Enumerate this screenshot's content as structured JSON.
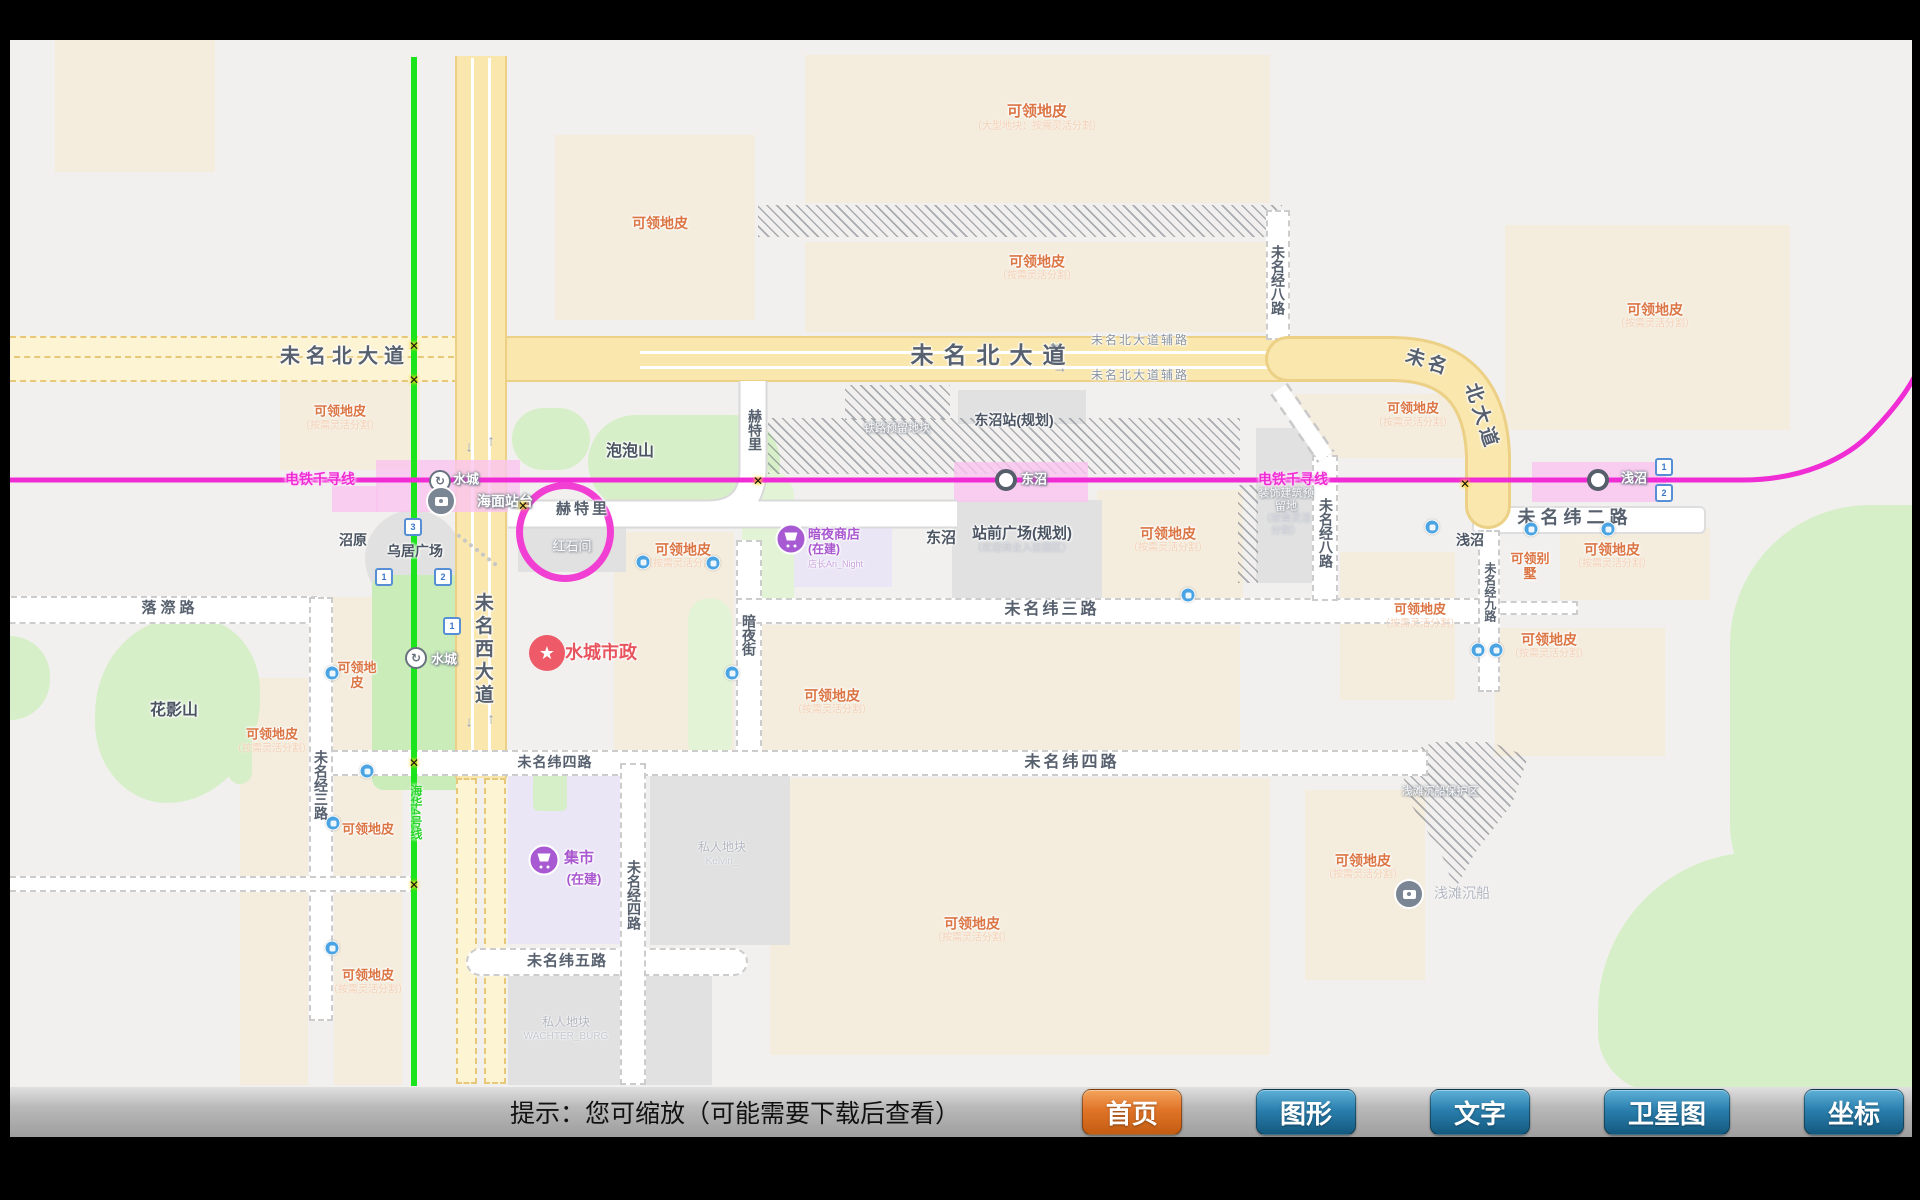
{
  "toolbar": {
    "hint": "提示：您可缩放（可能需要下载后查看）",
    "buttons": [
      {
        "label": "首页",
        "name": "home",
        "accent": true
      },
      {
        "label": "图形",
        "name": "graphics"
      },
      {
        "label": "文字",
        "name": "text"
      },
      {
        "label": "卫星图",
        "name": "satellite"
      },
      {
        "label": "坐标",
        "name": "coordinates"
      }
    ]
  },
  "map": {
    "colors": {
      "accent_orange": "#e07428",
      "button_blue": "#2a7fae",
      "metro_magenta": "#f02cd4",
      "metro_green": "#1ce41c",
      "claim_orange": "#db7544"
    },
    "labels": [
      {
        "t": "未名北大道",
        "x": 345,
        "y": 357,
        "s": 20,
        "ls": 6,
        "cls": "rd"
      },
      {
        "t": "未名北大道",
        "x": 993,
        "y": 355,
        "s": 23,
        "ls": 10,
        "cls": "rd"
      },
      {
        "t": "未名北大道辅路",
        "x": 1140,
        "y": 341,
        "s": 12,
        "ls": 2,
        "cls": "rd2"
      },
      {
        "t": "未名北大道辅路",
        "x": 1140,
        "y": 376,
        "s": 12,
        "ls": 2,
        "cls": "rd2"
      },
      {
        "t": "未名",
        "x": 1428,
        "y": 363,
        "s": 19,
        "ls": 4,
        "cls": "rd",
        "rot": 18
      },
      {
        "t": "北大道",
        "x": 1481,
        "y": 417,
        "s": 19,
        "ls": 4,
        "cls": "rd",
        "rot": 72
      },
      {
        "t": "未名西大道",
        "x": 482,
        "y": 650,
        "s": 19,
        "ls": 4,
        "v": 1,
        "cls": "rd"
      },
      {
        "t": "未名纬二路",
        "x": 1575,
        "y": 518,
        "s": 18,
        "ls": 5,
        "cls": "rd"
      },
      {
        "t": "未名纬三路",
        "x": 1052,
        "y": 610,
        "s": 16,
        "ls": 3,
        "cls": "rd"
      },
      {
        "t": "未名纬四路",
        "x": 555,
        "y": 762,
        "s": 14,
        "ls": 1,
        "cls": "rd"
      },
      {
        "t": "未名纬四路",
        "x": 1072,
        "y": 763,
        "s": 16,
        "ls": 3,
        "cls": "rd"
      },
      {
        "t": "未名纬五路",
        "x": 567,
        "y": 961,
        "s": 15,
        "ls": 1,
        "cls": "rd"
      },
      {
        "t": "落漈路",
        "x": 170,
        "y": 608,
        "s": 15,
        "ls": 4,
        "cls": "rd"
      },
      {
        "t": "未名经三路",
        "x": 321,
        "y": 785,
        "s": 14,
        "v": 1,
        "cls": "rd"
      },
      {
        "t": "未名经四路",
        "x": 634,
        "y": 895,
        "s": 14,
        "v": 1,
        "cls": "rd"
      },
      {
        "t": "未名经八路",
        "x": 1278,
        "y": 280,
        "s": 14,
        "v": 1,
        "cls": "rd"
      },
      {
        "t": "未名经八路",
        "x": 1326,
        "y": 533,
        "s": 14,
        "v": 1,
        "cls": "rd"
      },
      {
        "t": "未名经九路",
        "x": 1489,
        "y": 592,
        "s": 12,
        "v": 1,
        "cls": "rd"
      },
      {
        "t": "赫特里",
        "x": 583,
        "y": 509,
        "s": 15,
        "ls": 3,
        "cls": "rd"
      },
      {
        "t": "赫特里",
        "x": 755,
        "y": 430,
        "s": 14,
        "v": 1,
        "cls": "rd"
      },
      {
        "t": "暗夜街",
        "x": 749,
        "y": 635,
        "s": 14,
        "v": 1,
        "cls": "rd"
      },
      {
        "t": "泡泡山",
        "x": 630,
        "y": 452,
        "s": 16,
        "cls": "pl"
      },
      {
        "t": "花影山",
        "x": 174,
        "y": 711,
        "s": 16,
        "cls": "pl"
      },
      {
        "t": "沼原",
        "x": 353,
        "y": 540,
        "s": 14,
        "cls": "pl"
      },
      {
        "t": "乌居广场",
        "x": 415,
        "y": 551,
        "s": 14,
        "cls": "pl"
      },
      {
        "t": "东沼",
        "x": 941,
        "y": 538,
        "s": 15,
        "cls": "pl"
      },
      {
        "t": "浅沼",
        "x": 1470,
        "y": 540,
        "s": 14,
        "cls": "pl"
      },
      {
        "t": "东沼站(规划)",
        "x": 1014,
        "y": 420,
        "s": 14,
        "cls": "pl"
      },
      {
        "t": "站前广场(规划)",
        "x": 1022,
        "y": 540,
        "s": 15,
        "cls": "pl",
        "sub": "（欢迎商业入驻园区）"
      },
      {
        "t": "红石间",
        "x": 572,
        "y": 547,
        "s": 13,
        "cls": "wl"
      },
      {
        "t": "铁路预留地块",
        "x": 897,
        "y": 429,
        "s": 11,
        "cls": "wl"
      },
      {
        "t": "装饰建筑预留地",
        "x": 1286,
        "y": 512,
        "s": 11,
        "cls": "wl",
        "w": 56,
        "sub": "（按需灵活分割）"
      },
      {
        "t": "浅滩沉船保护区",
        "x": 1440,
        "y": 792,
        "s": 11,
        "cls": "wl"
      },
      {
        "t": "私人地块",
        "x": 722,
        "y": 854,
        "s": 12,
        "cls": "gl",
        "sub": "Kelvin_"
      },
      {
        "t": "私人地块",
        "x": 566,
        "y": 1029,
        "s": 12,
        "cls": "gl",
        "sub": "WACHTER_BURG"
      },
      {
        "t": "可领地皮",
        "x": 660,
        "y": 223,
        "s": 14,
        "cls": "cl"
      },
      {
        "t": "可领地皮",
        "x": 1037,
        "y": 118,
        "s": 15,
        "cls": "cl",
        "sub": "（大型地块：按需灵活分割）"
      },
      {
        "t": "可领地皮",
        "x": 1037,
        "y": 268,
        "s": 14,
        "cls": "cl",
        "sub": "（按需灵活分割）"
      },
      {
        "t": "可领地皮",
        "x": 1655,
        "y": 316,
        "s": 14,
        "cls": "cl",
        "sub": "（按需灵活分割）"
      },
      {
        "t": "可领地皮",
        "x": 340,
        "y": 418,
        "s": 13,
        "cls": "cl",
        "sub": "（按需灵活分割）"
      },
      {
        "t": "可领地皮",
        "x": 683,
        "y": 556,
        "s": 14,
        "cls": "cl",
        "sub": "（按需灵活分割）"
      },
      {
        "t": "可领地皮",
        "x": 1168,
        "y": 540,
        "s": 14,
        "cls": "cl",
        "sub": "（按需灵活分割）"
      },
      {
        "t": "可领地皮",
        "x": 832,
        "y": 702,
        "s": 14,
        "cls": "cl",
        "sub": "（按需灵活分割）"
      },
      {
        "t": "可领地皮",
        "x": 972,
        "y": 930,
        "s": 14,
        "cls": "cl",
        "sub": "（按需灵活分割）"
      },
      {
        "t": "可领地皮",
        "x": 272,
        "y": 741,
        "s": 13,
        "cls": "cl",
        "sub": "（按需灵活分割）"
      },
      {
        "t": "可领地皮",
        "x": 368,
        "y": 830,
        "s": 13,
        "cls": "cl"
      },
      {
        "t": "可领地皮",
        "x": 368,
        "y": 982,
        "s": 13,
        "cls": "cl",
        "sub": "（按需灵活分割）"
      },
      {
        "t": "可领地皮",
        "x": 357,
        "y": 676,
        "s": 13,
        "cls": "cl",
        "w": 46
      },
      {
        "t": "可领地皮",
        "x": 1612,
        "y": 556,
        "s": 14,
        "cls": "cl",
        "sub": "（按需灵活分割）"
      },
      {
        "t": "可领地皮",
        "x": 1420,
        "y": 616,
        "s": 13,
        "cls": "cl",
        "sub": "（按需灵活分割）"
      },
      {
        "t": "可领地皮",
        "x": 1549,
        "y": 646,
        "s": 14,
        "cls": "cl",
        "sub": "（按需灵活分割）"
      },
      {
        "t": "可领地皮",
        "x": 1363,
        "y": 867,
        "s": 14,
        "cls": "cl",
        "sub": "（按需灵活分割）"
      },
      {
        "t": "可领地皮",
        "x": 1413,
        "y": 415,
        "s": 13,
        "cls": "cl",
        "sub": "（按需灵活分割）"
      },
      {
        "t": "可领别墅",
        "x": 1530,
        "y": 567,
        "s": 13,
        "cls": "cl",
        "w": 42
      },
      {
        "t": "水城",
        "x": 466,
        "y": 480,
        "s": 13,
        "cls": "st"
      },
      {
        "t": "海面站台",
        "x": 505,
        "y": 501,
        "s": 14,
        "cls": "st"
      },
      {
        "t": "水城",
        "x": 444,
        "y": 660,
        "s": 13,
        "cls": "st"
      },
      {
        "t": "东沼",
        "x": 1034,
        "y": 480,
        "s": 13,
        "cls": "st"
      },
      {
        "t": "浅沼",
        "x": 1634,
        "y": 479,
        "s": 13,
        "cls": "st"
      },
      {
        "t": "浅滩沉船",
        "x": 1462,
        "y": 893,
        "s": 14,
        "cls": "gl"
      },
      {
        "t": "电铁千寻线",
        "x": 320,
        "y": 479,
        "s": 14,
        "cls": "ml"
      },
      {
        "t": "电铁千寻线",
        "x": 1293,
        "y": 479,
        "s": 14,
        "cls": "ml"
      },
      {
        "t": "海华4号线",
        "x": 415,
        "y": 812,
        "s": 12,
        "v": 1,
        "cls": "gn"
      },
      {
        "t": "水城市政",
        "x": 601,
        "y": 653,
        "s": 18,
        "cls": "red"
      },
      {
        "t": "集市",
        "x": 579,
        "y": 858,
        "s": 15,
        "cls": "pur"
      },
      {
        "t": "(在建)",
        "x": 584,
        "y": 880,
        "s": 13,
        "cls": "pur"
      },
      {
        "t": "暗夜商店",
        "x": 808,
        "y": 535,
        "s": 13,
        "cls": "pur",
        "a": "l"
      },
      {
        "t": "(在建)",
        "x": 808,
        "y": 550,
        "s": 12,
        "cls": "pur",
        "a": "l"
      },
      {
        "t": "店长An_Night",
        "x": 808,
        "y": 564,
        "s": 9,
        "cls": "pur2",
        "a": "l"
      }
    ],
    "icons": [
      {
        "k": "loop",
        "t": "↻",
        "x": 440,
        "y": 481
      },
      {
        "k": "loop",
        "t": "↻",
        "x": 416,
        "y": 658
      },
      {
        "k": "cam",
        "x": 441,
        "y": 501
      },
      {
        "k": "cam",
        "x": 1409,
        "y": 894
      },
      {
        "k": "dot",
        "x": 1006,
        "y": 480
      },
      {
        "k": "dot",
        "x": 1598,
        "y": 480
      },
      {
        "k": "star",
        "t": "★",
        "x": 547,
        "y": 653
      },
      {
        "k": "cart",
        "x": 544,
        "y": 860
      },
      {
        "k": "cart",
        "x": 791,
        "y": 539
      },
      {
        "k": "cross",
        "t": "✕",
        "x": 414,
        "y": 346
      },
      {
        "k": "cross",
        "t": "✕",
        "x": 414,
        "y": 380
      },
      {
        "k": "cross",
        "t": "✕",
        "x": 523,
        "y": 506
      },
      {
        "k": "cross",
        "t": "✕",
        "x": 758,
        "y": 481
      },
      {
        "k": "cross",
        "t": "✕",
        "x": 1465,
        "y": 484
      },
      {
        "k": "cross",
        "t": "✕",
        "x": 414,
        "y": 763
      },
      {
        "k": "cross",
        "t": "✕",
        "x": 414,
        "y": 885
      },
      {
        "k": "bus",
        "x": 643,
        "y": 562
      },
      {
        "k": "bus",
        "x": 713,
        "y": 563
      },
      {
        "k": "bus",
        "x": 732,
        "y": 673
      },
      {
        "k": "bus",
        "x": 1188,
        "y": 595
      },
      {
        "k": "bus",
        "x": 332,
        "y": 673
      },
      {
        "k": "bus",
        "x": 367,
        "y": 771
      },
      {
        "k": "bus",
        "x": 333,
        "y": 823
      },
      {
        "k": "bus",
        "x": 332,
        "y": 948
      },
      {
        "k": "bus",
        "x": 1432,
        "y": 527
      },
      {
        "k": "bus",
        "x": 1531,
        "y": 529
      },
      {
        "k": "bus",
        "x": 1608,
        "y": 529
      },
      {
        "k": "bus",
        "x": 1478,
        "y": 650
      },
      {
        "k": "bus",
        "x": 1496,
        "y": 650
      },
      {
        "k": "num",
        "t": "3",
        "x": 413,
        "y": 527
      },
      {
        "k": "num",
        "t": "1",
        "x": 384,
        "y": 577
      },
      {
        "k": "num",
        "t": "2",
        "x": 443,
        "y": 577
      },
      {
        "k": "num",
        "t": "1",
        "x": 452,
        "y": 626
      },
      {
        "k": "num",
        "t": "1",
        "x": 1664,
        "y": 467
      },
      {
        "k": "num",
        "t": "2",
        "x": 1664,
        "y": 493
      },
      {
        "k": "ar",
        "t": "↓",
        "x": 469,
        "y": 447
      },
      {
        "k": "ar",
        "t": "↑",
        "x": 491,
        "y": 441
      },
      {
        "k": "ar",
        "t": "↓",
        "x": 469,
        "y": 722
      },
      {
        "k": "ar",
        "t": "↑",
        "x": 491,
        "y": 719
      },
      {
        "k": "ar",
        "t": "←",
        "x": 1055,
        "y": 343
      },
      {
        "k": "ar",
        "t": "→",
        "x": 1060,
        "y": 368
      }
    ]
  }
}
